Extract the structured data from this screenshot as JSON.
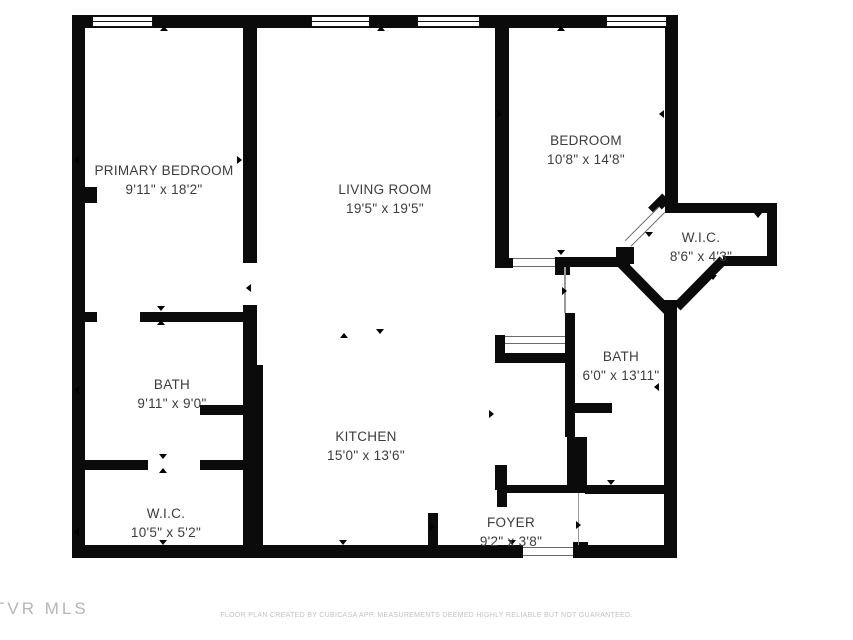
{
  "floor_plan": {
    "rooms": [
      {
        "id": "primary-bedroom",
        "name": "PRIMARY BEDROOM",
        "dimensions": "9'11\" x 18'2\""
      },
      {
        "id": "living-room",
        "name": "LIVING ROOM",
        "dimensions": "19'5\" x 19'5\""
      },
      {
        "id": "bedroom",
        "name": "BEDROOM",
        "dimensions": "10'8\" x 14'8\""
      },
      {
        "id": "wic-right",
        "name": "W.I.C.",
        "dimensions": "8'6\" x 4'3\""
      },
      {
        "id": "bath-right",
        "name": "BATH",
        "dimensions": "6'0\" x 13'11\""
      },
      {
        "id": "bath-left",
        "name": "BATH",
        "dimensions": "9'11\" x 9'0\""
      },
      {
        "id": "kitchen",
        "name": "KITCHEN",
        "dimensions": "15'0\" x 13'6\""
      },
      {
        "id": "wic-left",
        "name": "W.I.C.",
        "dimensions": "10'5\" x 5'2\""
      },
      {
        "id": "foyer",
        "name": "FOYER",
        "dimensions": "9'2\" x 3'8\""
      }
    ],
    "watermark": "TVR MLS",
    "disclaimer": "FLOOR PLAN CREATED BY CUBICASA APP. MEASUREMENTS DEEMED HIGHLY RELIABLE BUT NOT GUARANTEED.",
    "colors": {
      "wall": "#0b0b0b",
      "background": "#ffffff",
      "label_text": "#3c3c3c",
      "watermark": "#b5b5b5",
      "disclaimer": "#c2c2c2"
    }
  }
}
